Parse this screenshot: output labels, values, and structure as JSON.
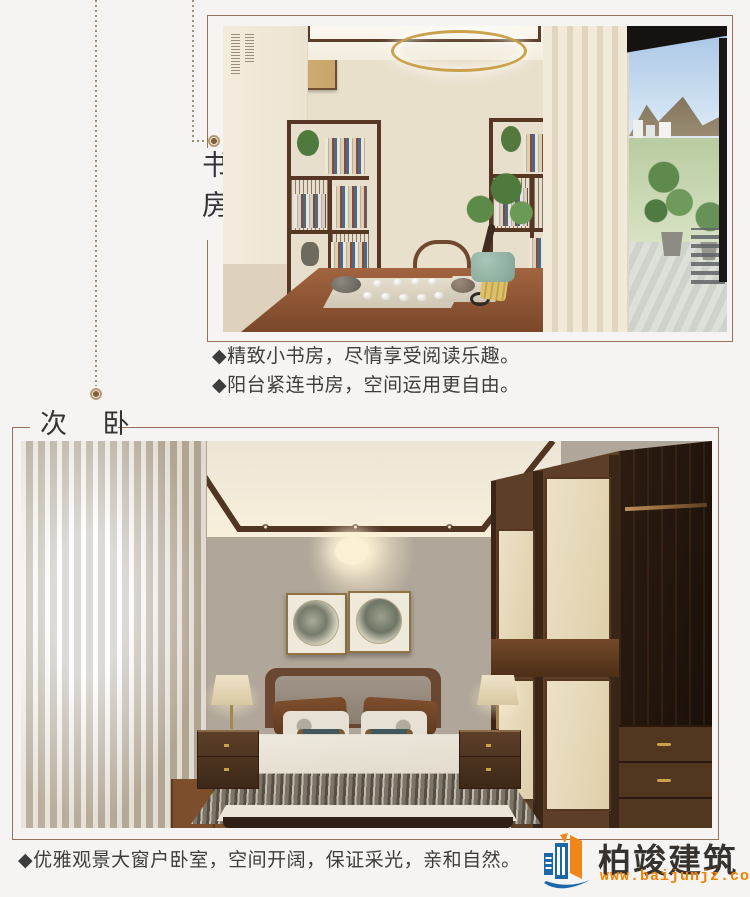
{
  "study": {
    "label": "书房",
    "bullets": [
      "◆精致小书房，尽情享受阅读乐趣。",
      "◆阳台紧连书房，空间运用更自由。"
    ],
    "artwork_text": "茶道"
  },
  "bedroom": {
    "label": "次 卧",
    "bullet": "◆优雅观景大窗户卧室，空间开阔，保证采光，亲和自然。"
  },
  "logo": {
    "company": "柏竣建筑",
    "website": "www.baijunjz.com"
  },
  "colors": {
    "page_background": "#f5f4f2",
    "frame_line": "#96705a",
    "dotted_guide": "#a28d75",
    "heading_text": "#343434",
    "body_text": "#3d3d3d",
    "logo_text": "#37322d",
    "logo_orange": "#ef8200",
    "logo_blue": "#1b67aa"
  }
}
